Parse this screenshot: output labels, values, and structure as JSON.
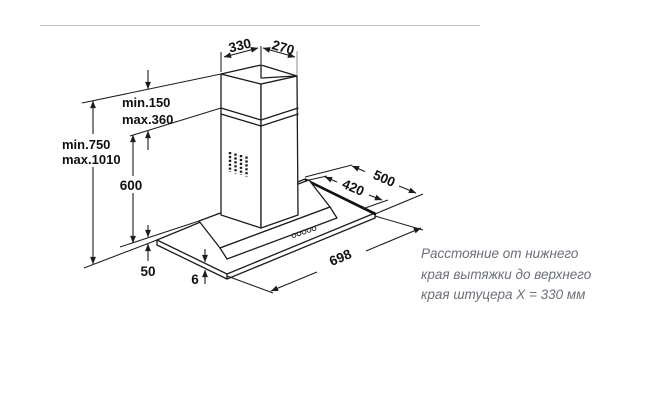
{
  "drawing": {
    "dims": {
      "duct_top_width": "330",
      "duct_top_depth": "270",
      "chimney_telescopic_min": "min.150",
      "chimney_telescopic_max": "max.360",
      "mount_height_min": "min.750",
      "mount_height_max": "max.1010",
      "lower_section_height": "600",
      "body_front_height": "50",
      "glass_thickness": "6",
      "hood_width": "698",
      "body_depth": "420",
      "glass_depth": "500"
    }
  },
  "note": {
    "lines": [
      "Расстояние от нижнего",
      "края вытяжки до верхнего",
      "края штуцера X = 330 мм"
    ]
  }
}
